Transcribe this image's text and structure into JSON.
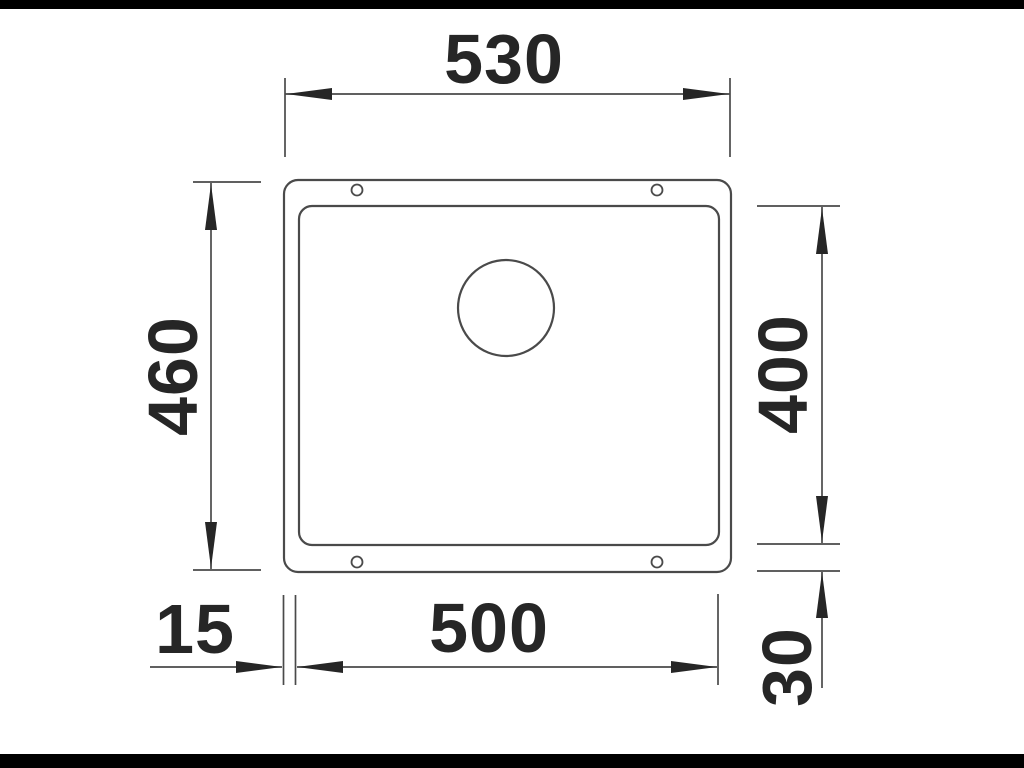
{
  "diagram": {
    "type": "technical-dimension-drawing",
    "subject": "undermount sink, top view",
    "units": "mm"
  },
  "dimensions": {
    "overall_width": "530",
    "overall_depth": "460",
    "bowl_depth": "400",
    "bowl_width": "500",
    "rim_offset_left": "15",
    "rim_offset_bottom": "30"
  },
  "colors": {
    "background": "#ffffff",
    "letterbox_bar": "#000000",
    "line": "#4a4a4a",
    "ink": "#262626"
  }
}
